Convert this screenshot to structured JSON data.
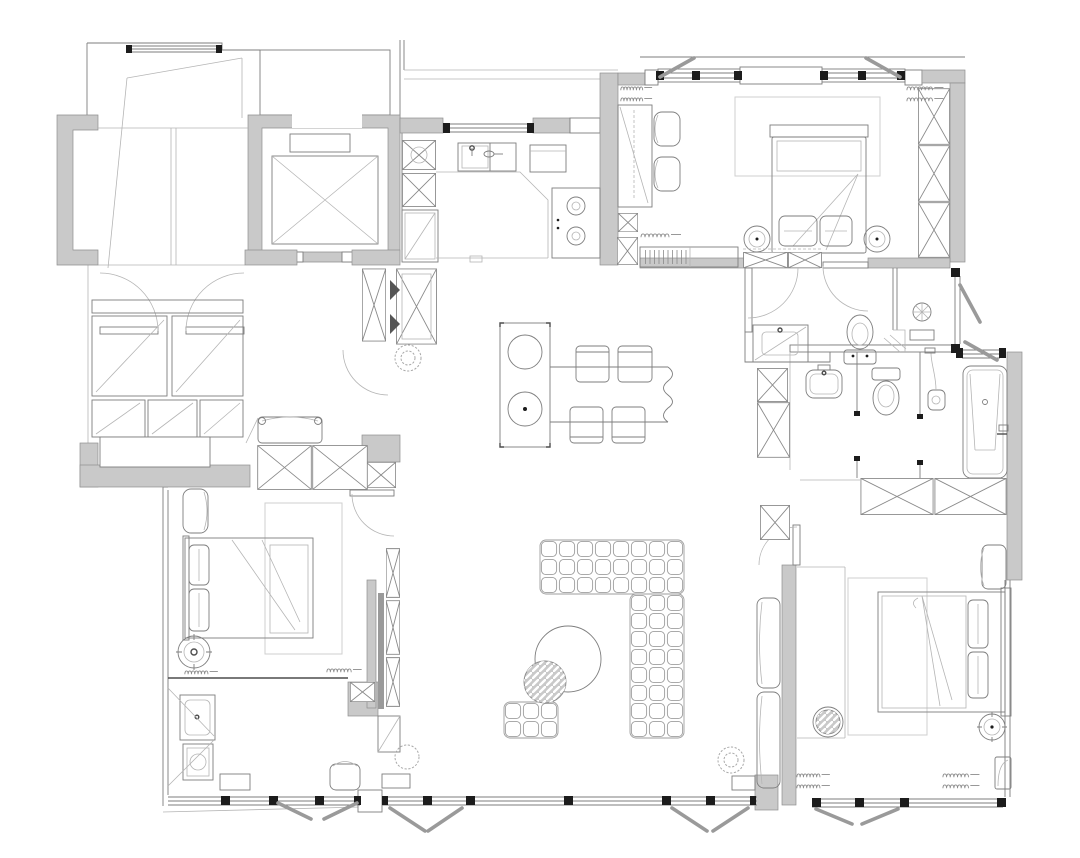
{
  "canvas": {
    "width": 1080,
    "height": 858
  },
  "colors": {
    "paper": "#ffffff",
    "wall": "#c9c9c9",
    "wall_edge": "#8f8f8f",
    "ink": "#7e7e7e",
    "ink_dark": "#4d4d4d",
    "ink_light": "#b5b5b5",
    "black": "#1c1c1c",
    "sash": "#9a9a9a",
    "rug": "#cfcfcf",
    "hatch_fill": "#c9c9c9"
  },
  "plan": {
    "type": "apartment-floor-plan",
    "rooms": [
      "foyer-stair-hall",
      "elevator-lobby",
      "entry-closet-hall",
      "kitchen",
      "bedroom-top-right",
      "dressing-hallway",
      "bathroom-upper",
      "bathroom-lower",
      "living-dining-room",
      "bedroom-bottom-left",
      "bathroom-bottom-left",
      "master-bedroom"
    ],
    "fixture_symbols": [
      "elevator-car",
      "entry-double-door",
      "storage-cabinet-x",
      "wardrobe-x",
      "window-band",
      "open-sash",
      "radiator-coil",
      "door-swing-arc",
      "kitchen-sink",
      "oven",
      "cooktop-two-burners",
      "refrigerator",
      "kitchen-island-with-basins",
      "dining-table-live-edge",
      "dining-chair",
      "modular-tufted-sofa",
      "ottoman",
      "round-coffee-table",
      "hatched-side-table",
      "bed-double",
      "pillow",
      "round-nightstand",
      "desk",
      "desk-chair",
      "vanity-sink",
      "toilet",
      "shower-head",
      "handheld-shower",
      "bathtub",
      "washer",
      "bench-seat",
      "armchair",
      "plant-scribble",
      "doormat-hatch",
      "rug"
    ]
  }
}
